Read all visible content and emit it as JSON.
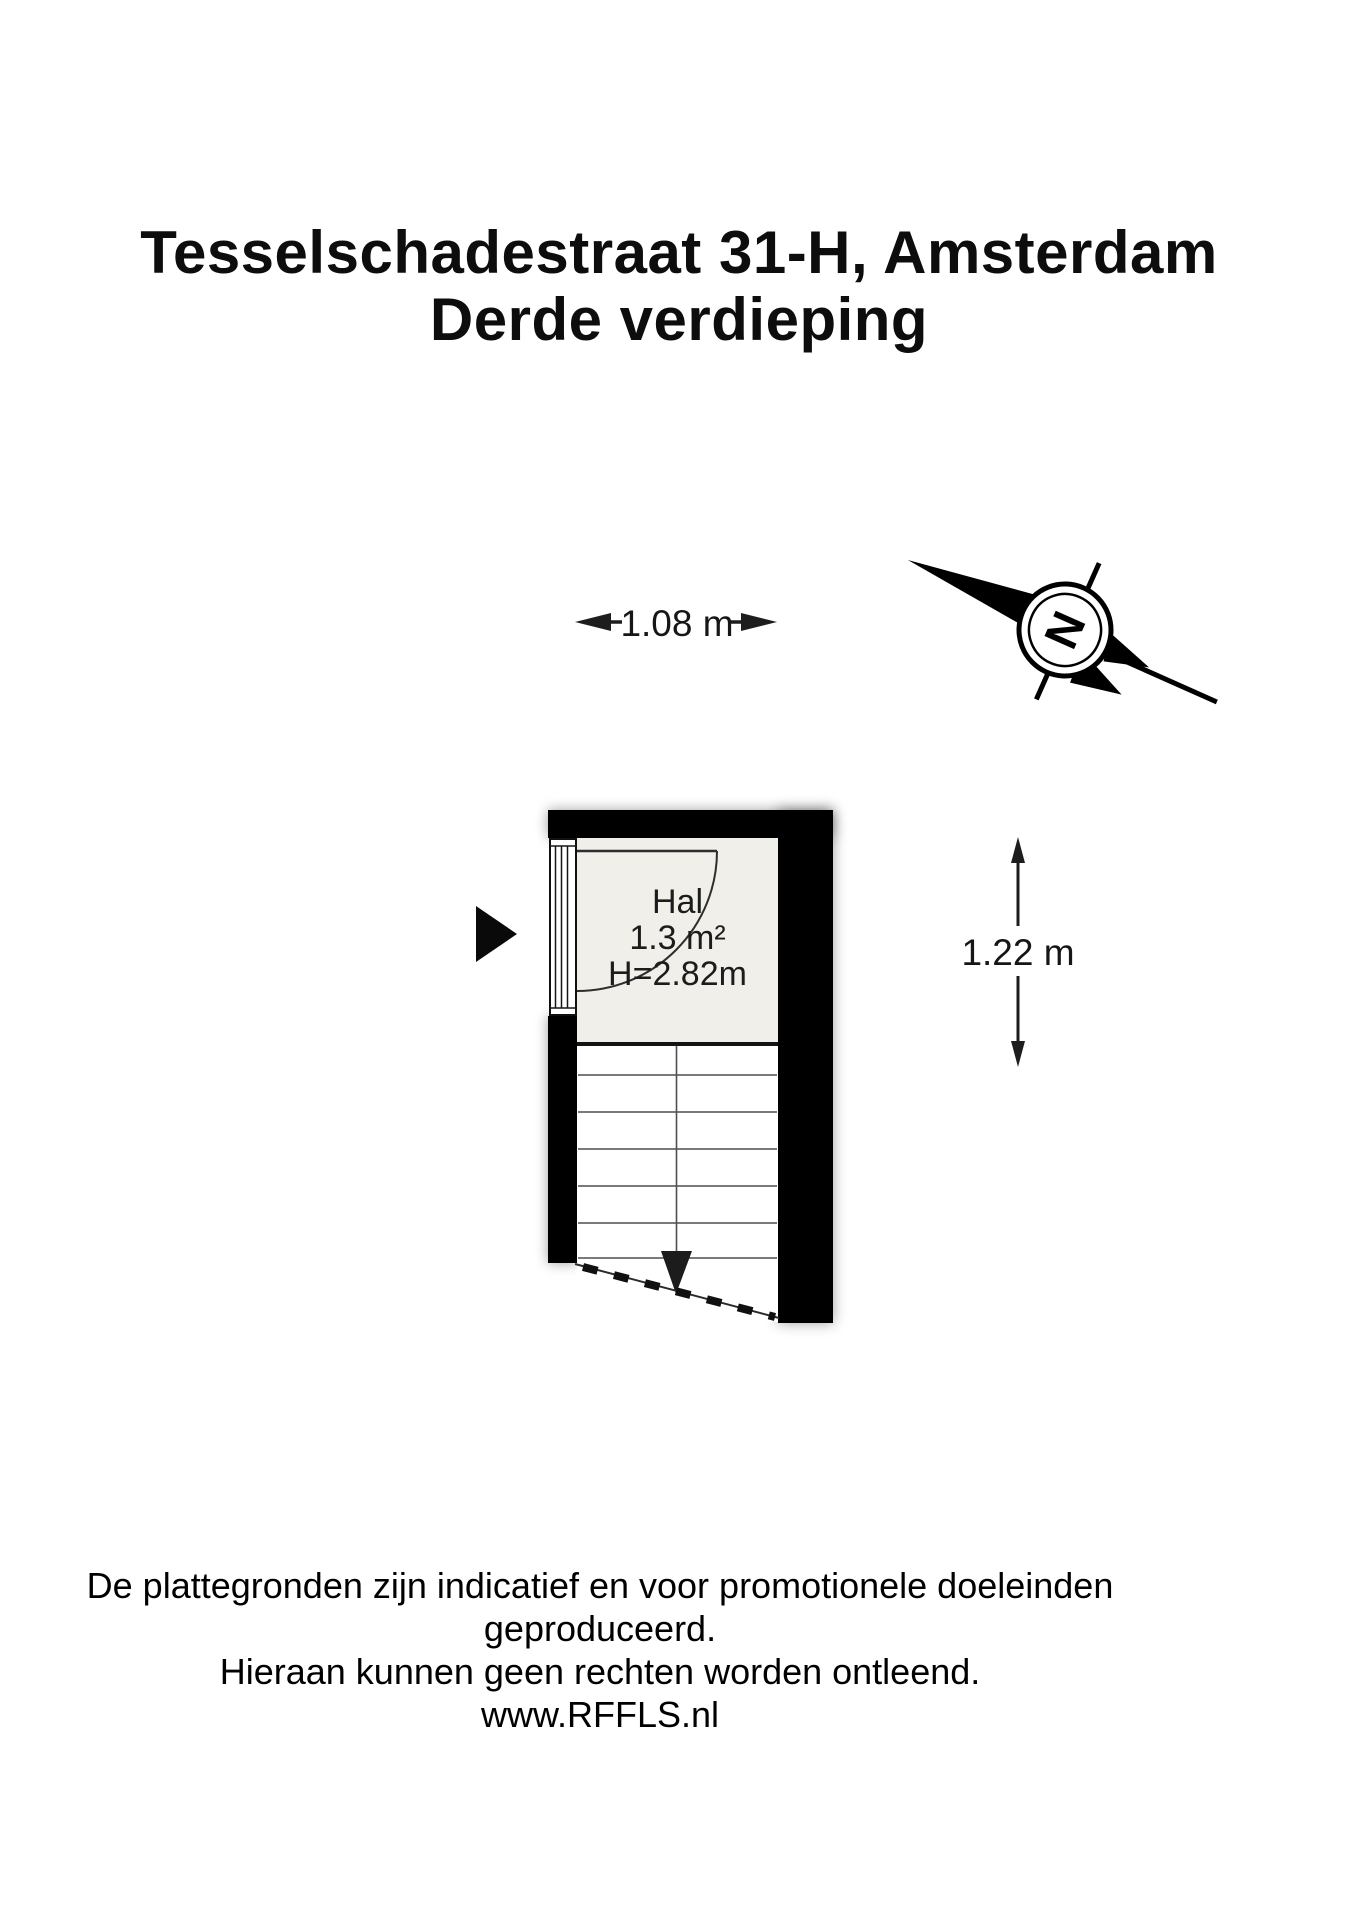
{
  "title": {
    "line1": "Tesselschadestraat 31-H, Amsterdam",
    "line2": "Derde verdieping"
  },
  "plan": {
    "room": {
      "name": "Hal",
      "area": "1.3 m²",
      "height": "H=2.82m"
    },
    "dimensions": {
      "width": "1.08 m",
      "depth": "1.22 m"
    },
    "compass": {
      "label": "N"
    }
  },
  "footer": {
    "line1": "De plattegronden zijn indicatief en voor promotionele doeleinden geproduceerd.",
    "line2": "Hieraan kunnen geen rechten worden ontleend.",
    "line3": "www.RFFLS.nl"
  },
  "colors": {
    "wall": "#000000",
    "room_fill": "#f0efe9",
    "line": "#3a3a3a",
    "text": "#111111",
    "background": "#ffffff"
  }
}
